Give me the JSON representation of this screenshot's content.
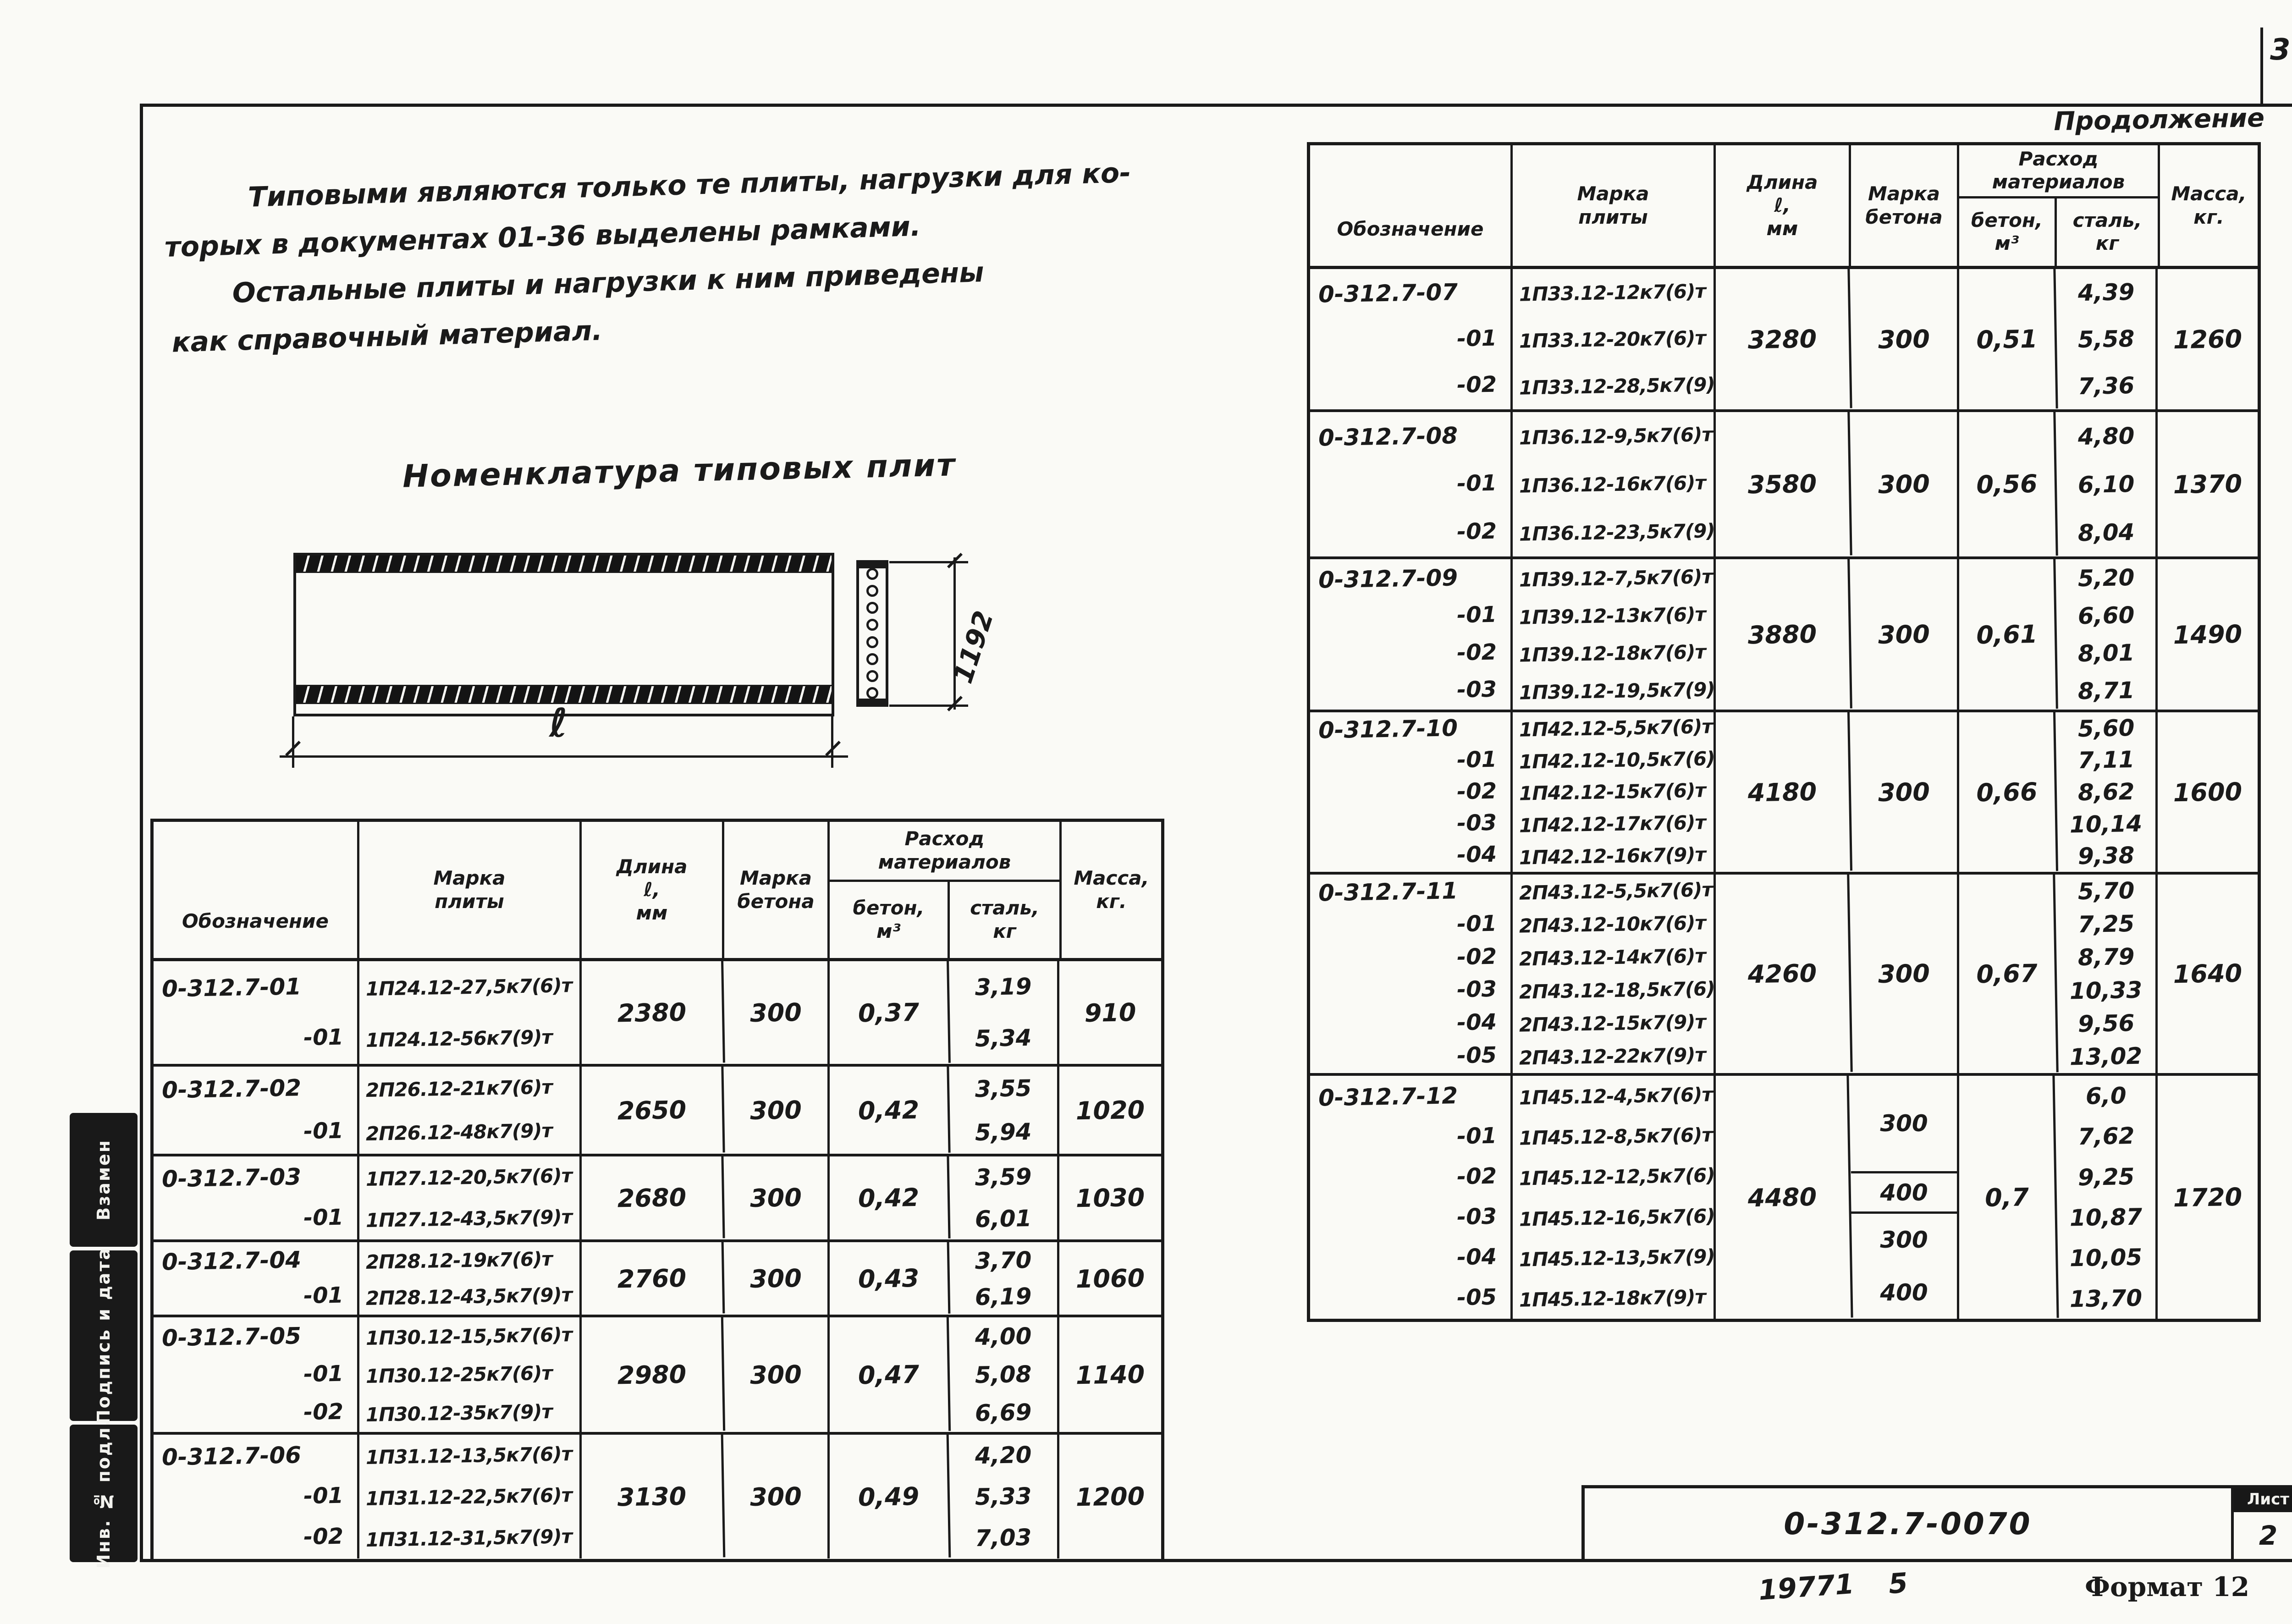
{
  "page": {
    "corner_number": "3",
    "continuation_label": "Продолжение",
    "notes_lines": [
      "Типовыми являются только те плиты, нагрузки для ко-",
      "торых в документах 01-36 выделены рамками.",
      "Остальные плиты и нагрузки к ним приведены",
      "как справочный материал."
    ],
    "section_title": "Номенклатура типовых плит",
    "drawing": {
      "length_dim": "ℓ",
      "width_dim": "1192"
    },
    "margin_stamps": [
      "Взамен",
      "Подпись и дата",
      "Инв. № подл."
    ],
    "title_block": {
      "doc_number": "0-312.7-0070",
      "sheet_label": "Лист",
      "sheet_number": "2"
    },
    "footer": {
      "left_code": "19771",
      "center_code": "5",
      "format_label": "Формат 12"
    }
  },
  "table_headers": {
    "designation": "Обозначение",
    "mark_l1": "Марка",
    "mark_l2": "плиты",
    "length_l1": "Длина",
    "length_l2": "ℓ,",
    "length_l3": "мм",
    "grade_l1": "Марка",
    "grade_l2": "бетона",
    "consumption_l1": "Расход",
    "consumption_l2": "материалов",
    "concrete_sub_l1": "бетон,",
    "concrete_sub_l2": "м³",
    "steel_sub_l1": "сталь,",
    "steel_sub_l2": "кг",
    "mass_l1": "Масса,",
    "mass_l2": "кг."
  },
  "plates_left": [
    {
      "designation": "0-312.7-01",
      "suffixes": [
        "-01"
      ],
      "marks": [
        "1П24.12-27,5к7(6)т",
        "1П24.12-56к7(9)т"
      ],
      "length_mm": "2380",
      "concrete_grade": "300",
      "concrete_m3": "0,37",
      "steel_kg": [
        "3,19",
        "5,34"
      ],
      "mass_kg": "910"
    },
    {
      "designation": "0-312.7-02",
      "suffixes": [
        "-01"
      ],
      "marks": [
        "2П26.12-21к7(6)т",
        "2П26.12-48к7(9)т"
      ],
      "length_mm": "2650",
      "concrete_grade": "300",
      "concrete_m3": "0,42",
      "steel_kg": [
        "3,55",
        "5,94"
      ],
      "mass_kg": "1020"
    },
    {
      "designation": "0-312.7-03",
      "suffixes": [
        "-01"
      ],
      "marks": [
        "1П27.12-20,5к7(6)т",
        "1П27.12-43,5к7(9)т"
      ],
      "length_mm": "2680",
      "concrete_grade": "300",
      "concrete_m3": "0,42",
      "steel_kg": [
        "3,59",
        "6,01"
      ],
      "mass_kg": "1030"
    },
    {
      "designation": "0-312.7-04",
      "suffixes": [
        "-01"
      ],
      "marks": [
        "2П28.12-19к7(6)т",
        "2П28.12-43,5к7(9)т"
      ],
      "length_mm": "2760",
      "concrete_grade": "300",
      "concrete_m3": "0,43",
      "steel_kg": [
        "3,70",
        "6,19"
      ],
      "mass_kg": "1060"
    },
    {
      "designation": "0-312.7-05",
      "suffixes": [
        "-01",
        "-02"
      ],
      "marks": [
        "1П30.12-15,5к7(6)т",
        "1П30.12-25к7(6)т",
        "1П30.12-35к7(9)т"
      ],
      "length_mm": "2980",
      "concrete_grade": "300",
      "concrete_m3": "0,47",
      "steel_kg": [
        "4,00",
        "5,08",
        "6,69"
      ],
      "mass_kg": "1140"
    },
    {
      "designation": "0-312.7-06",
      "suffixes": [
        "-01",
        "-02"
      ],
      "marks": [
        "1П31.12-13,5к7(6)т",
        "1П31.12-22,5к7(6)т",
        "1П31.12-31,5к7(9)т"
      ],
      "length_mm": "3130",
      "concrete_grade": "300",
      "concrete_m3": "0,49",
      "steel_kg": [
        "4,20",
        "5,33",
        "7,03"
      ],
      "mass_kg": "1200"
    }
  ],
  "plates_right": [
    {
      "designation": "0-312.7-07",
      "suffixes": [
        "-01",
        "-02"
      ],
      "marks": [
        "1П33.12-12к7(6)т",
        "1П33.12-20к7(6)т",
        "1П33.12-28,5к7(9)т"
      ],
      "length_mm": "3280",
      "concrete_grade": "300",
      "concrete_m3": "0,51",
      "steel_kg": [
        "4,39",
        "5,58",
        "7,36"
      ],
      "mass_kg": "1260"
    },
    {
      "designation": "0-312.7-08",
      "suffixes": [
        "-01",
        "-02"
      ],
      "marks": [
        "1П36.12-9,5к7(6)т",
        "1П36.12-16к7(6)т",
        "1П36.12-23,5к7(9)т"
      ],
      "length_mm": "3580",
      "concrete_grade": "300",
      "concrete_m3": "0,56",
      "steel_kg": [
        "4,80",
        "6,10",
        "8,04"
      ],
      "mass_kg": "1370"
    },
    {
      "designation": "0-312.7-09",
      "suffixes": [
        "-01",
        "-02",
        "-03"
      ],
      "marks": [
        "1П39.12-7,5к7(6)т",
        "1П39.12-13к7(6)т",
        "1П39.12-18к7(6)т",
        "1П39.12-19,5к7(9)т"
      ],
      "length_mm": "3880",
      "concrete_grade": "300",
      "concrete_m3": "0,61",
      "steel_kg": [
        "5,20",
        "6,60",
        "8,01",
        "8,71"
      ],
      "mass_kg": "1490"
    },
    {
      "designation": "0-312.7-10",
      "suffixes": [
        "-01",
        "-02",
        "-03",
        "-04"
      ],
      "marks": [
        "1П42.12-5,5к7(6)т",
        "1П42.12-10,5к7(6)т",
        "1П42.12-15к7(6)т",
        "1П42.12-17к7(6)т",
        "1П42.12-16к7(9)т"
      ],
      "length_mm": "4180",
      "concrete_grade": "300",
      "concrete_m3": "0,66",
      "steel_kg": [
        "5,60",
        "7,11",
        "8,62",
        "10,14",
        "9,38"
      ],
      "mass_kg": "1600"
    },
    {
      "designation": "0-312.7-11",
      "suffixes": [
        "-01",
        "-02",
        "-03",
        "-04",
        "-05"
      ],
      "marks": [
        "2П43.12-5,5к7(6)т",
        "2П43.12-10к7(6)т",
        "2П43.12-14к7(6)т",
        "2П43.12-18,5к7(6)т",
        "2П43.12-15к7(9)т",
        "2П43.12-22к7(9)т"
      ],
      "length_mm": "4260",
      "concrete_grade": "300",
      "concrete_m3": "0,67",
      "steel_kg": [
        "5,70",
        "7,25",
        "8,79",
        "10,33",
        "9,56",
        "13,02"
      ],
      "mass_kg": "1640"
    },
    {
      "designation": "0-312.7-12",
      "suffixes": [
        "-01",
        "-02",
        "-03",
        "-04",
        "-05"
      ],
      "marks": [
        "1П45.12-4,5к7(6)т",
        "1П45.12-8,5к7(6)т",
        "1П45.12-12,5к7(6)т",
        "1П45.12-16,5к7(6)т",
        "1П45.12-13,5к7(9)т",
        "1П45.12-18к7(9)т"
      ],
      "length_mm": "4480",
      "concrete_grade": [
        "300",
        "400",
        "300",
        "400"
      ],
      "concrete_m3": "0,7",
      "steel_kg": [
        "6,0",
        "7,62",
        "9,25",
        "10,87",
        "10,05",
        "13,70"
      ],
      "mass_kg": "1720"
    }
  ]
}
